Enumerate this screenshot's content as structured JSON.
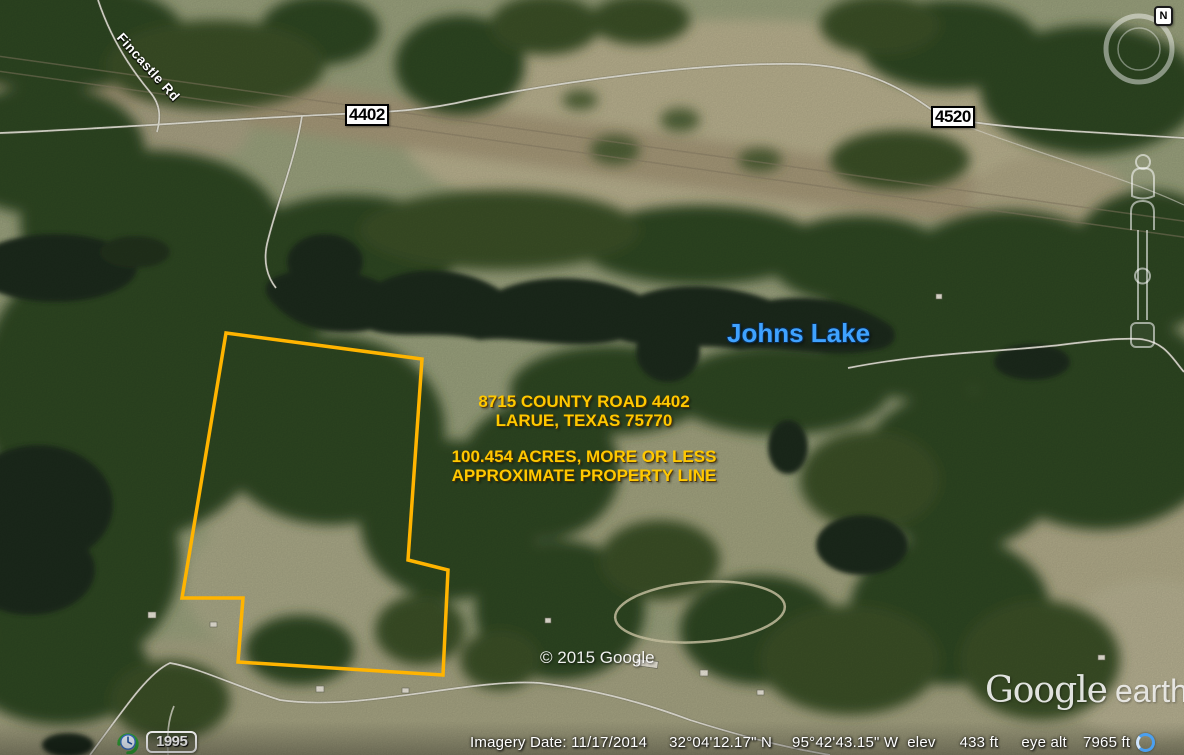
{
  "map_labels": {
    "fincastle_rd": "Fincastle Rd",
    "route_4402": "4402",
    "route_4520": "4520",
    "route_1995": "1995",
    "johns_lake": "Johns Lake",
    "copyright": "© 2015 Google"
  },
  "property_annotation": {
    "address_line1": "8715 COUNTY ROAD 4402",
    "address_line2": "LARUE, TEXAS 75770",
    "acreage_line": "100.454 ACRES, MORE OR LESS",
    "boundary_line": "APPROXIMATE PROPERTY LINE",
    "outline_color": "#FFB400",
    "text_color": "#FFC800"
  },
  "logo": {
    "google": "Google",
    "earth": "earth"
  },
  "compass": {
    "north_label": "N"
  },
  "status_bar": {
    "imagery_date": "Imagery Date: 11/17/2014",
    "latitude": "32°04'12.17\" N",
    "longitude": "95°42'43.15\" W",
    "elev_label": "elev",
    "elevation": "433 ft",
    "eye_alt_label": "eye alt",
    "eye_altitude": "7965 ft"
  },
  "colors": {
    "lake_label_blue": "#3FA2FF",
    "property_line_orange": "#FFB400",
    "annotation_yellow": "#FFC800"
  }
}
